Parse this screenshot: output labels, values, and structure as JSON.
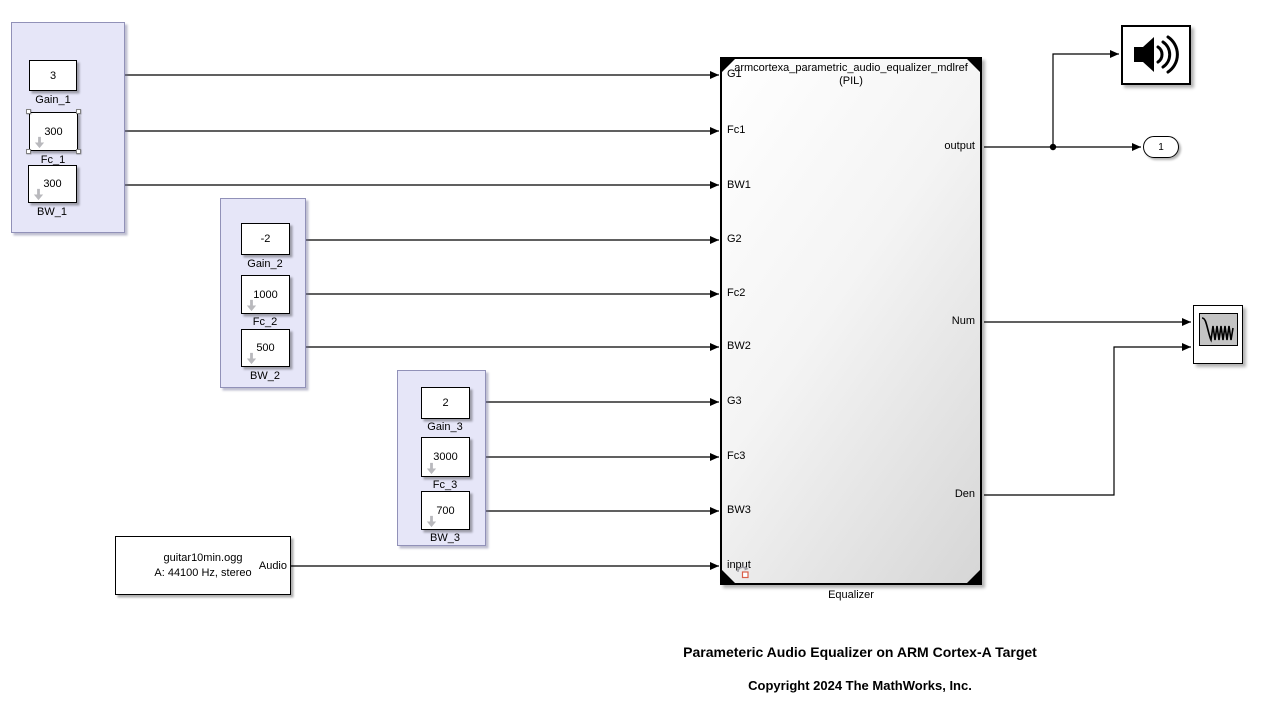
{
  "bands": [
    {
      "gain_label": "Gain_1",
      "gain_value": "3",
      "fc_label": "Fc_1",
      "fc_value": "300",
      "bw_label": "BW_1",
      "bw_value": "300"
    },
    {
      "gain_label": "Gain_2",
      "gain_value": "-2",
      "fc_label": "Fc_2",
      "fc_value": "1000",
      "bw_label": "BW_2",
      "bw_value": "500"
    },
    {
      "gain_label": "Gain_3",
      "gain_value": "2",
      "fc_label": "Fc_3",
      "fc_value": "3000",
      "bw_label": "BW_3",
      "bw_value": "700"
    }
  ],
  "equalizer": {
    "name_line1": "armcortexa_parametric_audio_equalizer_mdlref",
    "name_line2": "(PIL)",
    "caption": "Equalizer",
    "in_ports": [
      "G1",
      "Fc1",
      "BW1",
      "G2",
      "Fc2",
      "BW2",
      "G3",
      "Fc3",
      "BW3",
      "input"
    ],
    "out_ports": [
      "output",
      "Num",
      "Den"
    ]
  },
  "audio_source": {
    "file": "guitar10min.ogg",
    "format": "A: 44100 Hz, stereo",
    "port": "Audio"
  },
  "outport": {
    "label": "1"
  },
  "annotations": {
    "title": "Parameteric Audio Equalizer on ARM Cortex-A Target",
    "copyright": "Copyright 2024 The MathWorks, Inc."
  },
  "colors": {
    "group_fill": "#e6e6f8",
    "group_border": "#9191b8",
    "wire": "#000000",
    "badge_accent": "#d9604a"
  }
}
